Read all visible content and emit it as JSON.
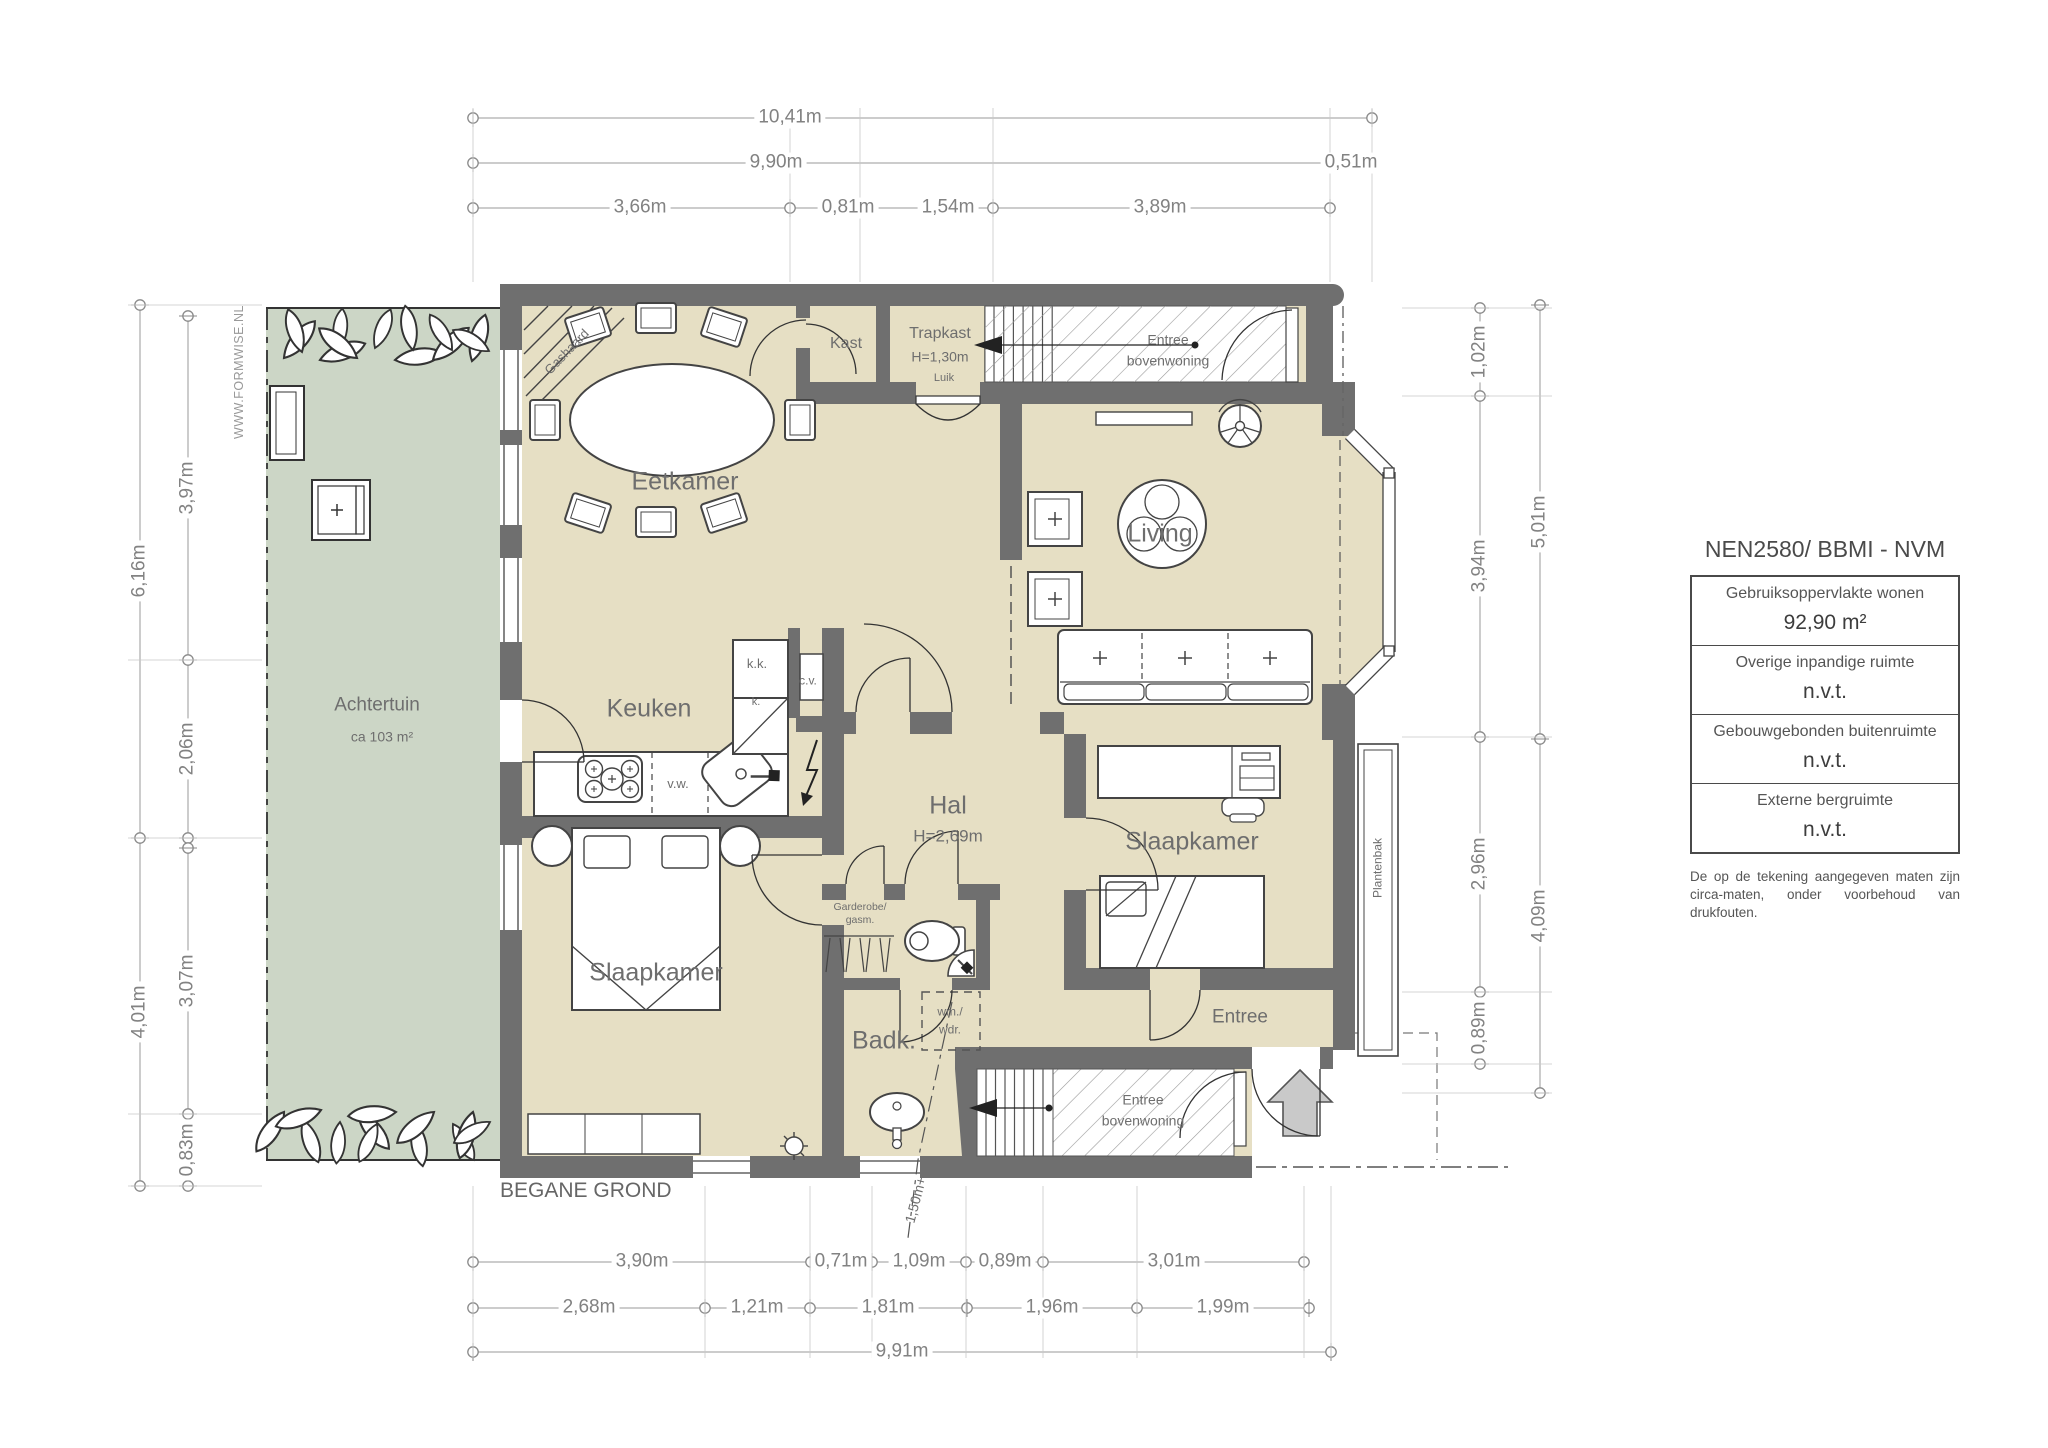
{
  "plan_title": "BEGANE GROND",
  "watermark": "WWW.FORMWISE.NL",
  "garden": {
    "name": "Achtertuin",
    "area": "ca 103 m²"
  },
  "rooms": {
    "eetkamer": "Eetkamer",
    "living": "Living",
    "keuken": "Keuken",
    "hal": "Hal",
    "hal_height": "H=2,69m",
    "slaapkamer_left": "Slaapkamer",
    "slaapkamer_right": "Slaapkamer",
    "badkamer": "Badk.",
    "entree": "Entree",
    "kast": "Kast",
    "trapkast": "Trapkast",
    "trapkast_height": "H=1,30m",
    "luik": "Luik",
    "entree_boven_1": "Entree",
    "entree_boven_2": "bovenwoning"
  },
  "fixtures": {
    "gashaard": "Gashaard",
    "kk": "k.k.",
    "cv": "c.v.",
    "k": "k.",
    "vw": "v.w.",
    "wm1": "wm./",
    "wm2": "wdr.",
    "garderobe1": "Garderobe/",
    "garderobe2": "gasm.",
    "plantenbak": "Plantenbak"
  },
  "dims": {
    "top": {
      "d1041": "10,41m",
      "d990": "9,90m",
      "d051": "0,51m",
      "d366": "3,66m",
      "d081": "0,81m",
      "d154": "1,54m",
      "d389": "3,89m"
    },
    "left": {
      "d616": "6,16m",
      "d397": "3,97m",
      "d206": "2,06m",
      "d307": "3,07m",
      "d401": "4,01m",
      "d083": "0,83m"
    },
    "right": {
      "d102": "1,02m",
      "d394": "3,94m",
      "d501": "5,01m",
      "d296": "2,96m",
      "d409": "4,09m",
      "d089": "0,89m"
    },
    "bottom": {
      "d390": "3,90m",
      "d071": "0,71m",
      "d109": "1,09m",
      "d089": "0,89m",
      "d301": "3,01m",
      "d268": "2,68m",
      "d121": "1,21m",
      "d181": "1,81m",
      "d196": "1,96m",
      "d199": "1,99m",
      "d991": "9,91m"
    },
    "height_marker": "1,50m+"
  },
  "legend": {
    "title": "NEN2580/ BBMI - NVM",
    "rows": [
      {
        "label": "Gebruiksoppervlakte wonen",
        "value": "92,90 m²"
      },
      {
        "label": "Overige inpandige ruimte",
        "value": "n.v.t."
      },
      {
        "label": "Gebouwgebonden buitenruimte",
        "value": "n.v.t."
      },
      {
        "label": "Externe bergruimte",
        "value": "n.v.t."
      }
    ],
    "note": "De op de tekening aangegeven maten zijn circa-maten, onder voorbehoud van drukfouten."
  },
  "colors": {
    "wall": "#6f6f6f",
    "floor": "#e6dfc4",
    "garden": "#ccd6c6",
    "dimline": "#9a9a9a",
    "dimtext": "#828282"
  }
}
